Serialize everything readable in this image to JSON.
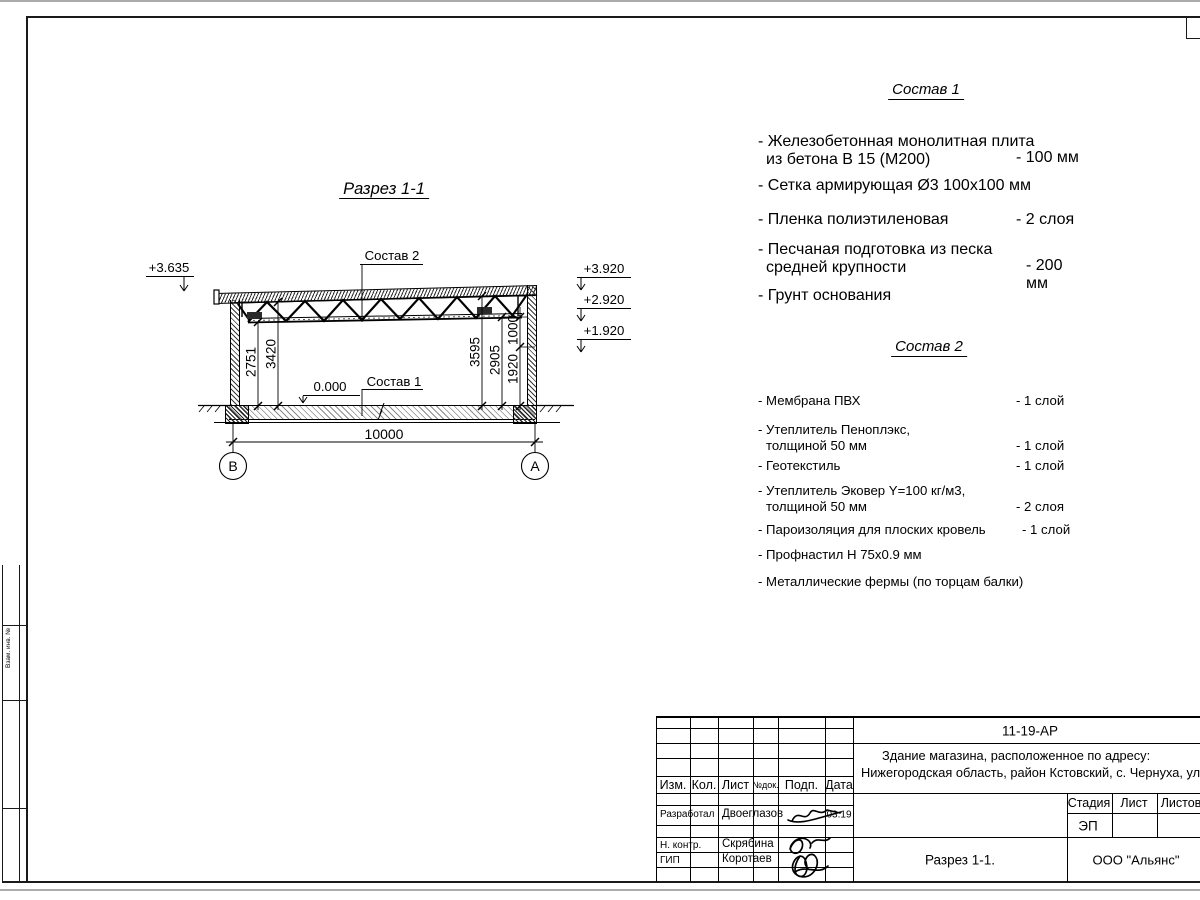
{
  "section": {
    "title": "Разрез 1-1",
    "label_sostav2": "Состав 2",
    "label_sostav1": "Состав 1",
    "level_zero": "0.000",
    "elev_left": "+3.635",
    "elev_r1": "+3.920",
    "elev_r2": "+2.920",
    "elev_r3": "+1.920",
    "dim_2751": "2751",
    "dim_3420": "3420",
    "dim_3595": "3595",
    "dim_2905": "2905",
    "dim_1920": "1920",
    "dim_1000": "1000",
    "dim_span": "10000",
    "axis_left": "В",
    "axis_right": "А"
  },
  "sostav1": {
    "title": "Состав 1",
    "items": [
      {
        "line1": "- Железобетонная  монолитная плита",
        "line2": "из бетона В 15 (М200)",
        "value": "- 100 мм"
      },
      {
        "line1": "- Сетка армирующая Ø3 100х100 мм",
        "line2": "",
        "value": ""
      },
      {
        "line1": "- Пленка полиэтиленовая",
        "line2": "",
        "value": "-  2 слоя"
      },
      {
        "line1": "- Песчаная подготовка из песка",
        "line2": "средней крупности",
        "value": "- 200 мм"
      },
      {
        "line1": "- Грунт основания",
        "line2": "",
        "value": ""
      }
    ]
  },
  "sostav2": {
    "title": "Состав 2",
    "items": [
      {
        "line1": "- Мембрана ПВХ",
        "line2": "",
        "value": "- 1 слой"
      },
      {
        "line1": "- Утеплитель Пеноплэкс,",
        "line2": "толщиной 50 мм",
        "value": "- 1 слой"
      },
      {
        "line1": "- Геотекстиль",
        "line2": "",
        "value": "- 1 слой"
      },
      {
        "line1": "- Утеплитель Эковер Y=100 кг/м3,",
        "line2": "толщиной 50 мм",
        "value": "- 2 слоя"
      },
      {
        "line1": "- Пароизоляция для плоских кровель",
        "line2": "",
        "value": "- 1 слой"
      },
      {
        "line1": "- Профнастил Н 75х0.9 мм",
        "line2": "",
        "value": ""
      },
      {
        "line1": "- Металлические фермы (по торцам балки)",
        "line2": "",
        "value": ""
      }
    ]
  },
  "titleblock": {
    "doc_code": "11-19-АР",
    "project_line1": "Здание магазина, расположенное по адресу:",
    "project_line2": "Нижегородская область, район Кстовский, с. Чернуха, ул. Нов",
    "col_izm": "Изм.",
    "col_kol": "Кол.",
    "col_list": "Лист",
    "col_ndok": "№док.",
    "col_podp": "Подп.",
    "col_data": "Дата",
    "row1_role": "Разработал",
    "row1_name": "Двоеглазов",
    "row1_date": "03.19",
    "row2_role": "Н. контр.",
    "row2_name": "Скрябина",
    "row3_role": "ГИП",
    "row3_name": "Коротаев",
    "stage_label": "Стадия",
    "sheet_label": "Лист",
    "sheets_label": "Листов",
    "stage_value": "ЭП",
    "sheet_title": "Разрез 1-1.",
    "company": "ООО \"Альянс\""
  },
  "side_strip": {
    "label": "Взам. инв. №"
  }
}
